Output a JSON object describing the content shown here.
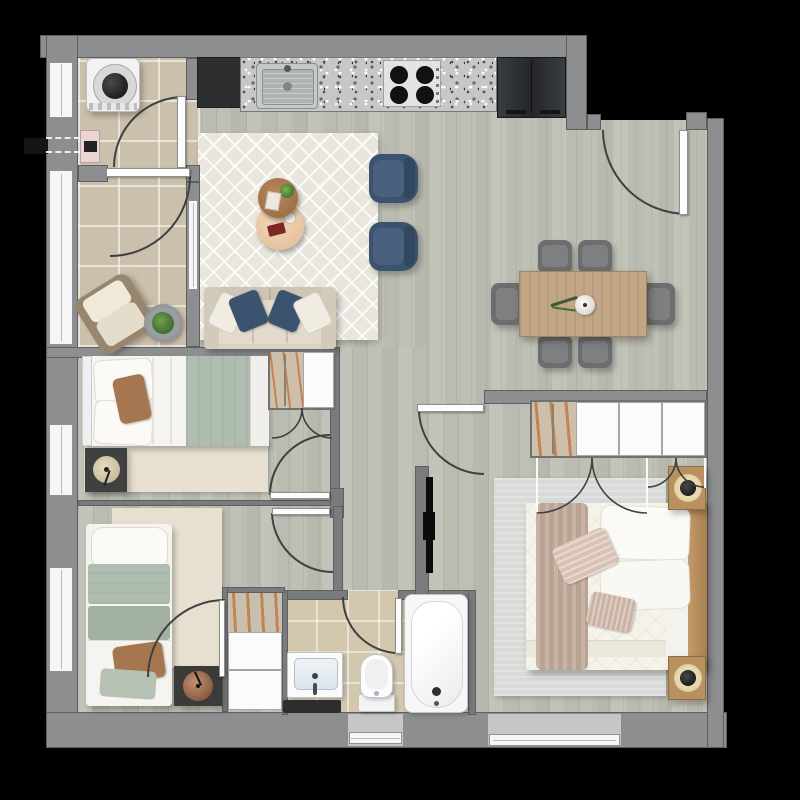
{
  "meta": {
    "kind": "apartment floor plan, top-down 2D render",
    "no_visible_text": true
  },
  "palette": {
    "background": "#000000",
    "outer_wall": "#8d8e90",
    "interior_wall": "#797b7d",
    "wood_floor": "#bfc0b5",
    "tile_floor": "#cbc0ab",
    "bathroom_tile": "#d3c7ae",
    "rug_cream": "#e9e6de",
    "rug_gray": "#d9d9d7",
    "accent_navy": "#3c536f",
    "accent_sage": "#aebdb0",
    "accent_tan_wood": "#b9905f",
    "accent_blush": "#d9c2b4",
    "appliance_dark": "#34373a"
  },
  "rooms": [
    {
      "name": "Laundry room",
      "furniture": [
        "washing machine",
        "utility connection",
        "door"
      ]
    },
    {
      "name": "Balcony sunroom",
      "furniture": [
        "wicker armchair",
        "potted plant",
        "window"
      ]
    },
    {
      "name": "Kitchen",
      "furniture": [
        "granite countertop",
        "sink",
        "cooktop",
        "refrigerator",
        "dark cabinet"
      ]
    },
    {
      "name": "Living room",
      "furniture": [
        "sofa",
        "throw pillows",
        "diamond rug",
        "round coffee tables",
        "navy armchairs"
      ]
    },
    {
      "name": "Dining area",
      "furniture": [
        "wood dining table",
        "six chairs",
        "centerpiece bowl"
      ]
    },
    {
      "name": "Entry",
      "furniture": [
        "entry door"
      ]
    },
    {
      "name": "Bedroom 1",
      "furniture": [
        "double bed",
        "nightstand",
        "lamp",
        "rug",
        "wardrobe with hangers",
        "window"
      ]
    },
    {
      "name": "Bedroom 2",
      "furniture": [
        "single bed",
        "nightstand",
        "lamp",
        "rug",
        "closet with hangers",
        "window"
      ]
    },
    {
      "name": "Bathroom",
      "furniture": [
        "vanity sink",
        "toilet",
        "bathtub",
        "dark mat",
        "window"
      ]
    },
    {
      "name": "Master bedroom",
      "furniture": [
        "double bed",
        "wood bed frame",
        "closet with sliding panels",
        "bifold doors",
        "two nightstands",
        "lamps",
        "gray rug",
        "window"
      ]
    },
    {
      "name": "Hallway",
      "furniture": [
        "wall-mounted TV partition"
      ]
    }
  ]
}
